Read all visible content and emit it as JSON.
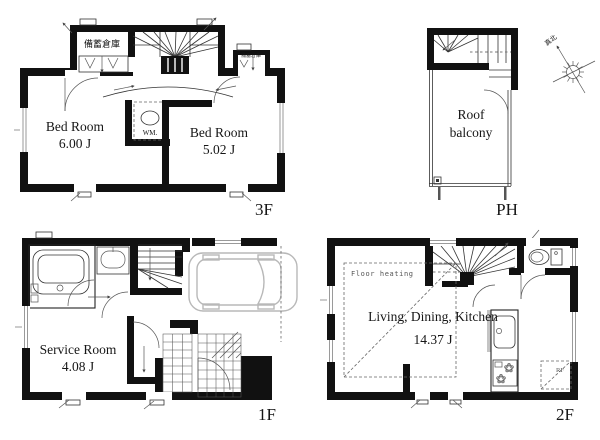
{
  "plans": {
    "f3": {
      "label": "3F",
      "storage_left": "備蓄倉庫",
      "storage_right": "備蓄倉庫",
      "bedroom1": {
        "name": "Bed Room",
        "size": "6.00 J"
      },
      "bedroom2": {
        "name": "Bed Room",
        "size": "5.02 J"
      },
      "wm": "WM."
    },
    "ph": {
      "label": "PH",
      "roof_balcony_line1": "Roof",
      "roof_balcony_line2": "balcony"
    },
    "compass": {
      "north_label": "真北"
    },
    "f1": {
      "label": "1F",
      "service_room": {
        "name": "Service Room",
        "size": "4.08 J"
      }
    },
    "f2": {
      "label": "2F",
      "floor_heating": "Floor heating",
      "ldk": {
        "name": "Living, Dining, Kitchen",
        "size": "14.37 J"
      },
      "rf": "RF"
    }
  }
}
